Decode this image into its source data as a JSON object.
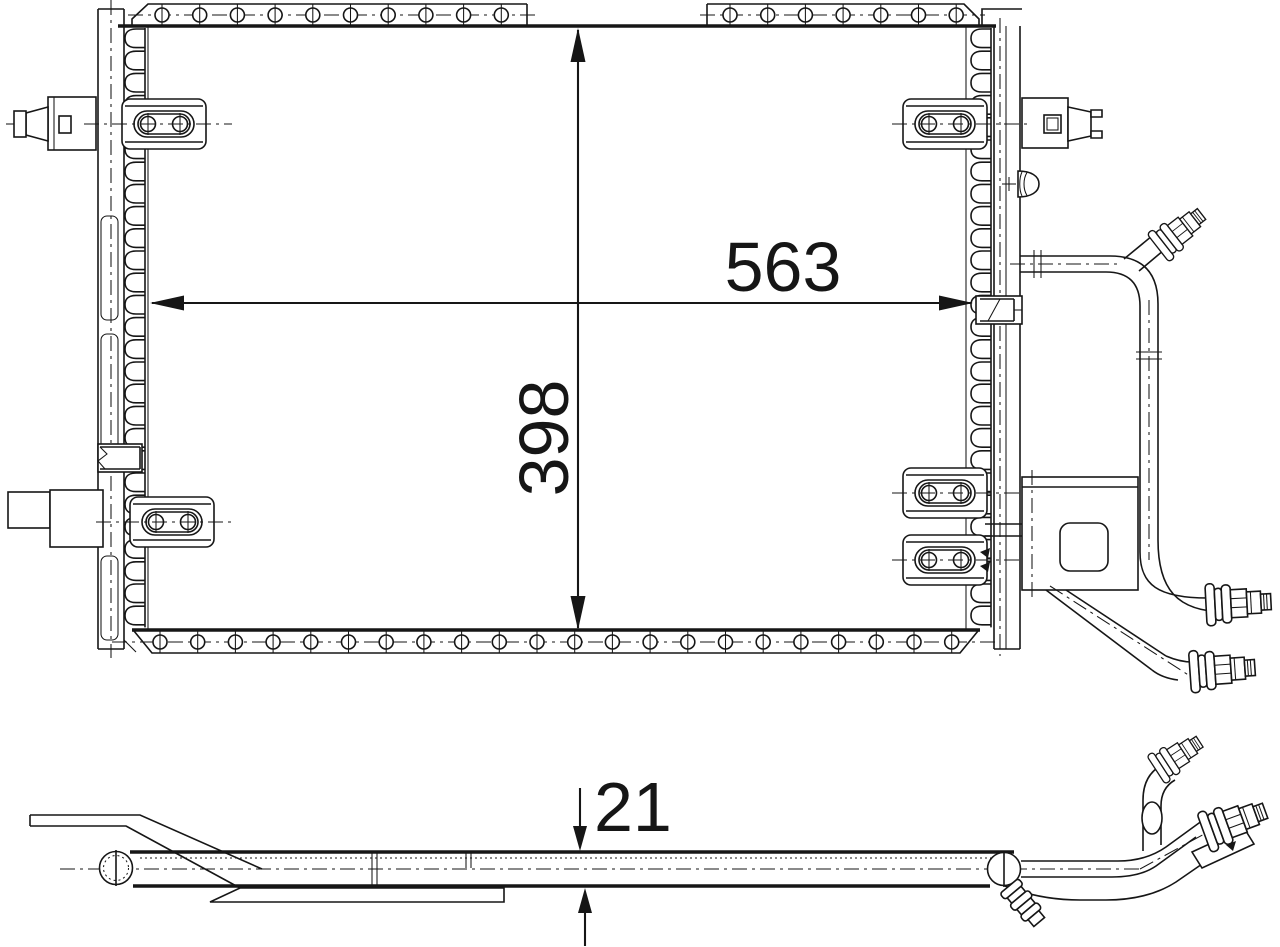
{
  "drawing": {
    "width_value": "563",
    "height_value": "398",
    "depth_value": "21"
  },
  "colors": {
    "line": "#161616",
    "background": "#ffffff"
  }
}
